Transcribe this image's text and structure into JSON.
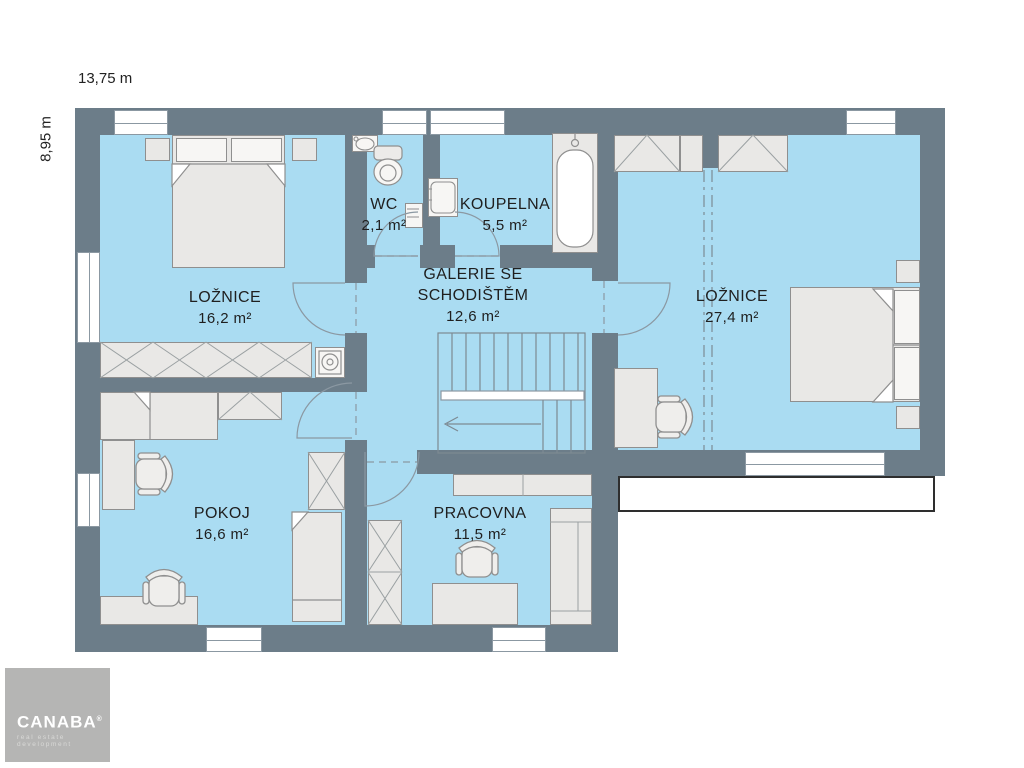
{
  "dimensions": {
    "width_label": "13,75 m",
    "height_label": "8,95 m"
  },
  "rooms": {
    "loznice_small": {
      "name": "LOŽNICE",
      "area": "16,2 m²"
    },
    "wc": {
      "name": "WC",
      "area": "2,1 m²"
    },
    "koupelna": {
      "name": "KOUPELNA",
      "area": "5,5 m²"
    },
    "galerie": {
      "name_line1": "GALERIE SE",
      "name_line2": "SCHODIŠTĚM",
      "area": "12,6 m²"
    },
    "loznice_large": {
      "name": "LOŽNICE",
      "area": "27,4 m²"
    },
    "pokoj": {
      "name": "POKOJ",
      "area": "16,6 m²"
    },
    "pracovna": {
      "name": "PRACOVNA",
      "area": "11,5 m²"
    }
  },
  "logo": {
    "brand": "CANABA",
    "registered": "®",
    "tagline": "real estate development"
  },
  "colors": {
    "wall": "#6c7d89",
    "floor": "#aadcf2",
    "furn": "#e9e8e6",
    "furn-border": "#8f8f8f",
    "line": "#8b98a2",
    "text": "#1f1f1f",
    "logo-bg": "#b5b5b4"
  }
}
